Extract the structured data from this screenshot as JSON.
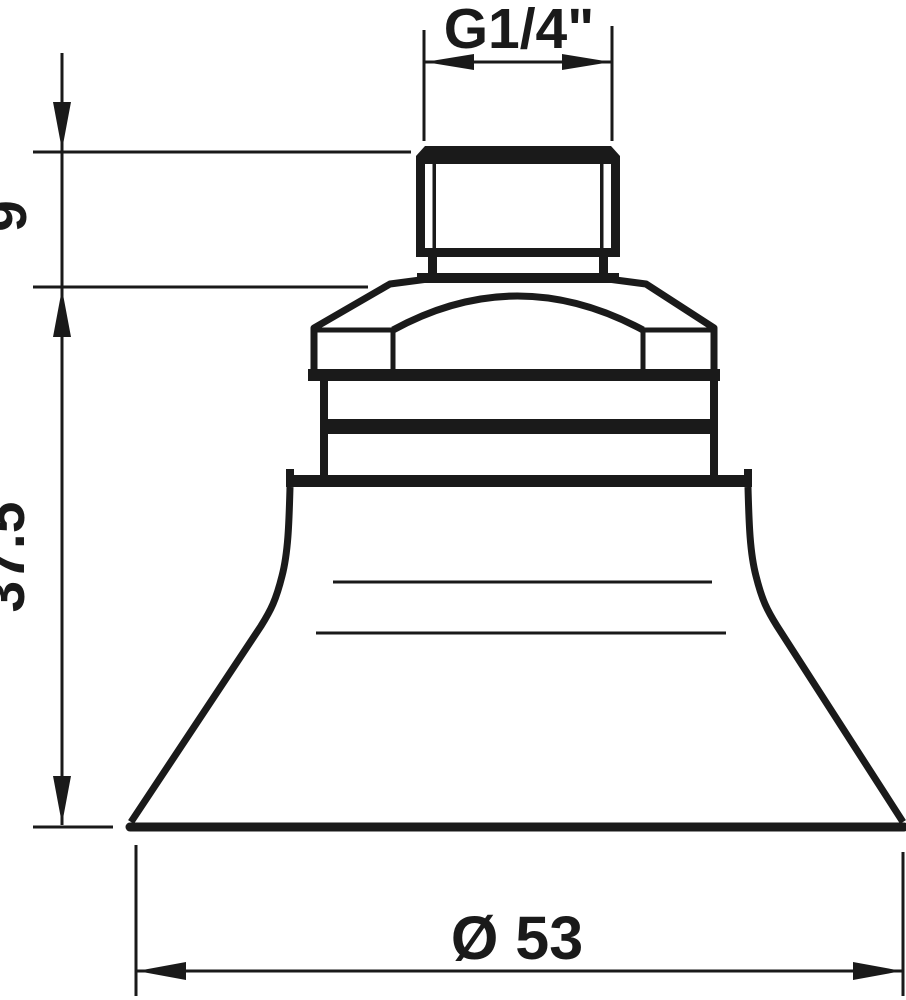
{
  "drawing": {
    "type": "technical-dimension-drawing",
    "subject": "suction cup with threaded fitting, side view",
    "colors": {
      "background": "#ffffff",
      "line": "#1a1a1a"
    },
    "dimensions": {
      "thread_label": "G1/4\"",
      "fitting_height": "9",
      "total_height": "37.5",
      "cup_diameter": "Ø 53"
    }
  }
}
